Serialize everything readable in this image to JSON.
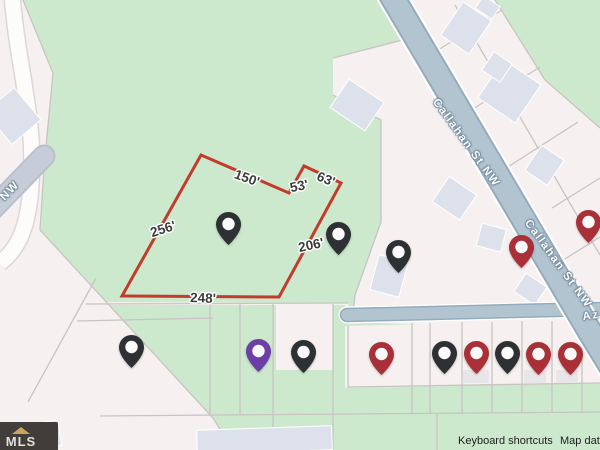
{
  "map": {
    "street_labels": [
      {
        "id": "street-callahan-upper",
        "text": "Callahan St NW",
        "x": 466,
        "y": 143,
        "rot": 54
      },
      {
        "id": "street-callahan-lower",
        "text": "Callahan St NW",
        "x": 558,
        "y": 264,
        "rot": 54
      },
      {
        "id": "street-az-partial",
        "text": "Az",
        "x": 591,
        "y": 316,
        "rot": -8
      },
      {
        "id": "street-nw-partial",
        "text": "NW",
        "x": 10,
        "y": 191,
        "rot": -46
      }
    ],
    "dimension_labels": [
      {
        "text": "150'",
        "x": 247,
        "y": 178,
        "rot": 20
      },
      {
        "text": "53'",
        "x": 299,
        "y": 186,
        "rot": -12
      },
      {
        "text": "63'",
        "x": 326,
        "y": 179,
        "rot": 22
      },
      {
        "text": "256'",
        "x": 163,
        "y": 229,
        "rot": -18
      },
      {
        "text": "206'",
        "x": 311,
        "y": 245,
        "rot": -12
      },
      {
        "text": "248'",
        "x": 203,
        "y": 298,
        "rot": 2
      }
    ],
    "pins": [
      {
        "color_key": "black",
        "cx": 228,
        "cy": 224
      },
      {
        "color_key": "black",
        "cx": 338,
        "cy": 234
      },
      {
        "color_key": "black",
        "cx": 398,
        "cy": 252
      },
      {
        "color_key": "red",
        "cx": 521,
        "cy": 247
      },
      {
        "color_key": "red",
        "cx": 588,
        "cy": 222
      },
      {
        "color_key": "black",
        "cx": 131,
        "cy": 347
      },
      {
        "color_key": "purple",
        "cx": 258,
        "cy": 351
      },
      {
        "color_key": "black",
        "cx": 303,
        "cy": 352
      },
      {
        "color_key": "red",
        "cx": 381,
        "cy": 354
      },
      {
        "color_key": "black",
        "cx": 444,
        "cy": 353
      },
      {
        "color_key": "red",
        "cx": 476,
        "cy": 353
      },
      {
        "color_key": "black",
        "cx": 507,
        "cy": 353
      },
      {
        "color_key": "red",
        "cx": 538,
        "cy": 354
      },
      {
        "color_key": "red",
        "cx": 570,
        "cy": 354
      }
    ],
    "pin_colors": {
      "black": "#2e3134",
      "red": "#a93036",
      "purple": "#6b3fa5"
    },
    "parcel_outline_color": "#c23b2d",
    "attribution": {
      "keyboard_shortcuts": "Keyboard shortcuts",
      "map_data": "Map data"
    },
    "watermark": {
      "text": "MLS"
    }
  }
}
